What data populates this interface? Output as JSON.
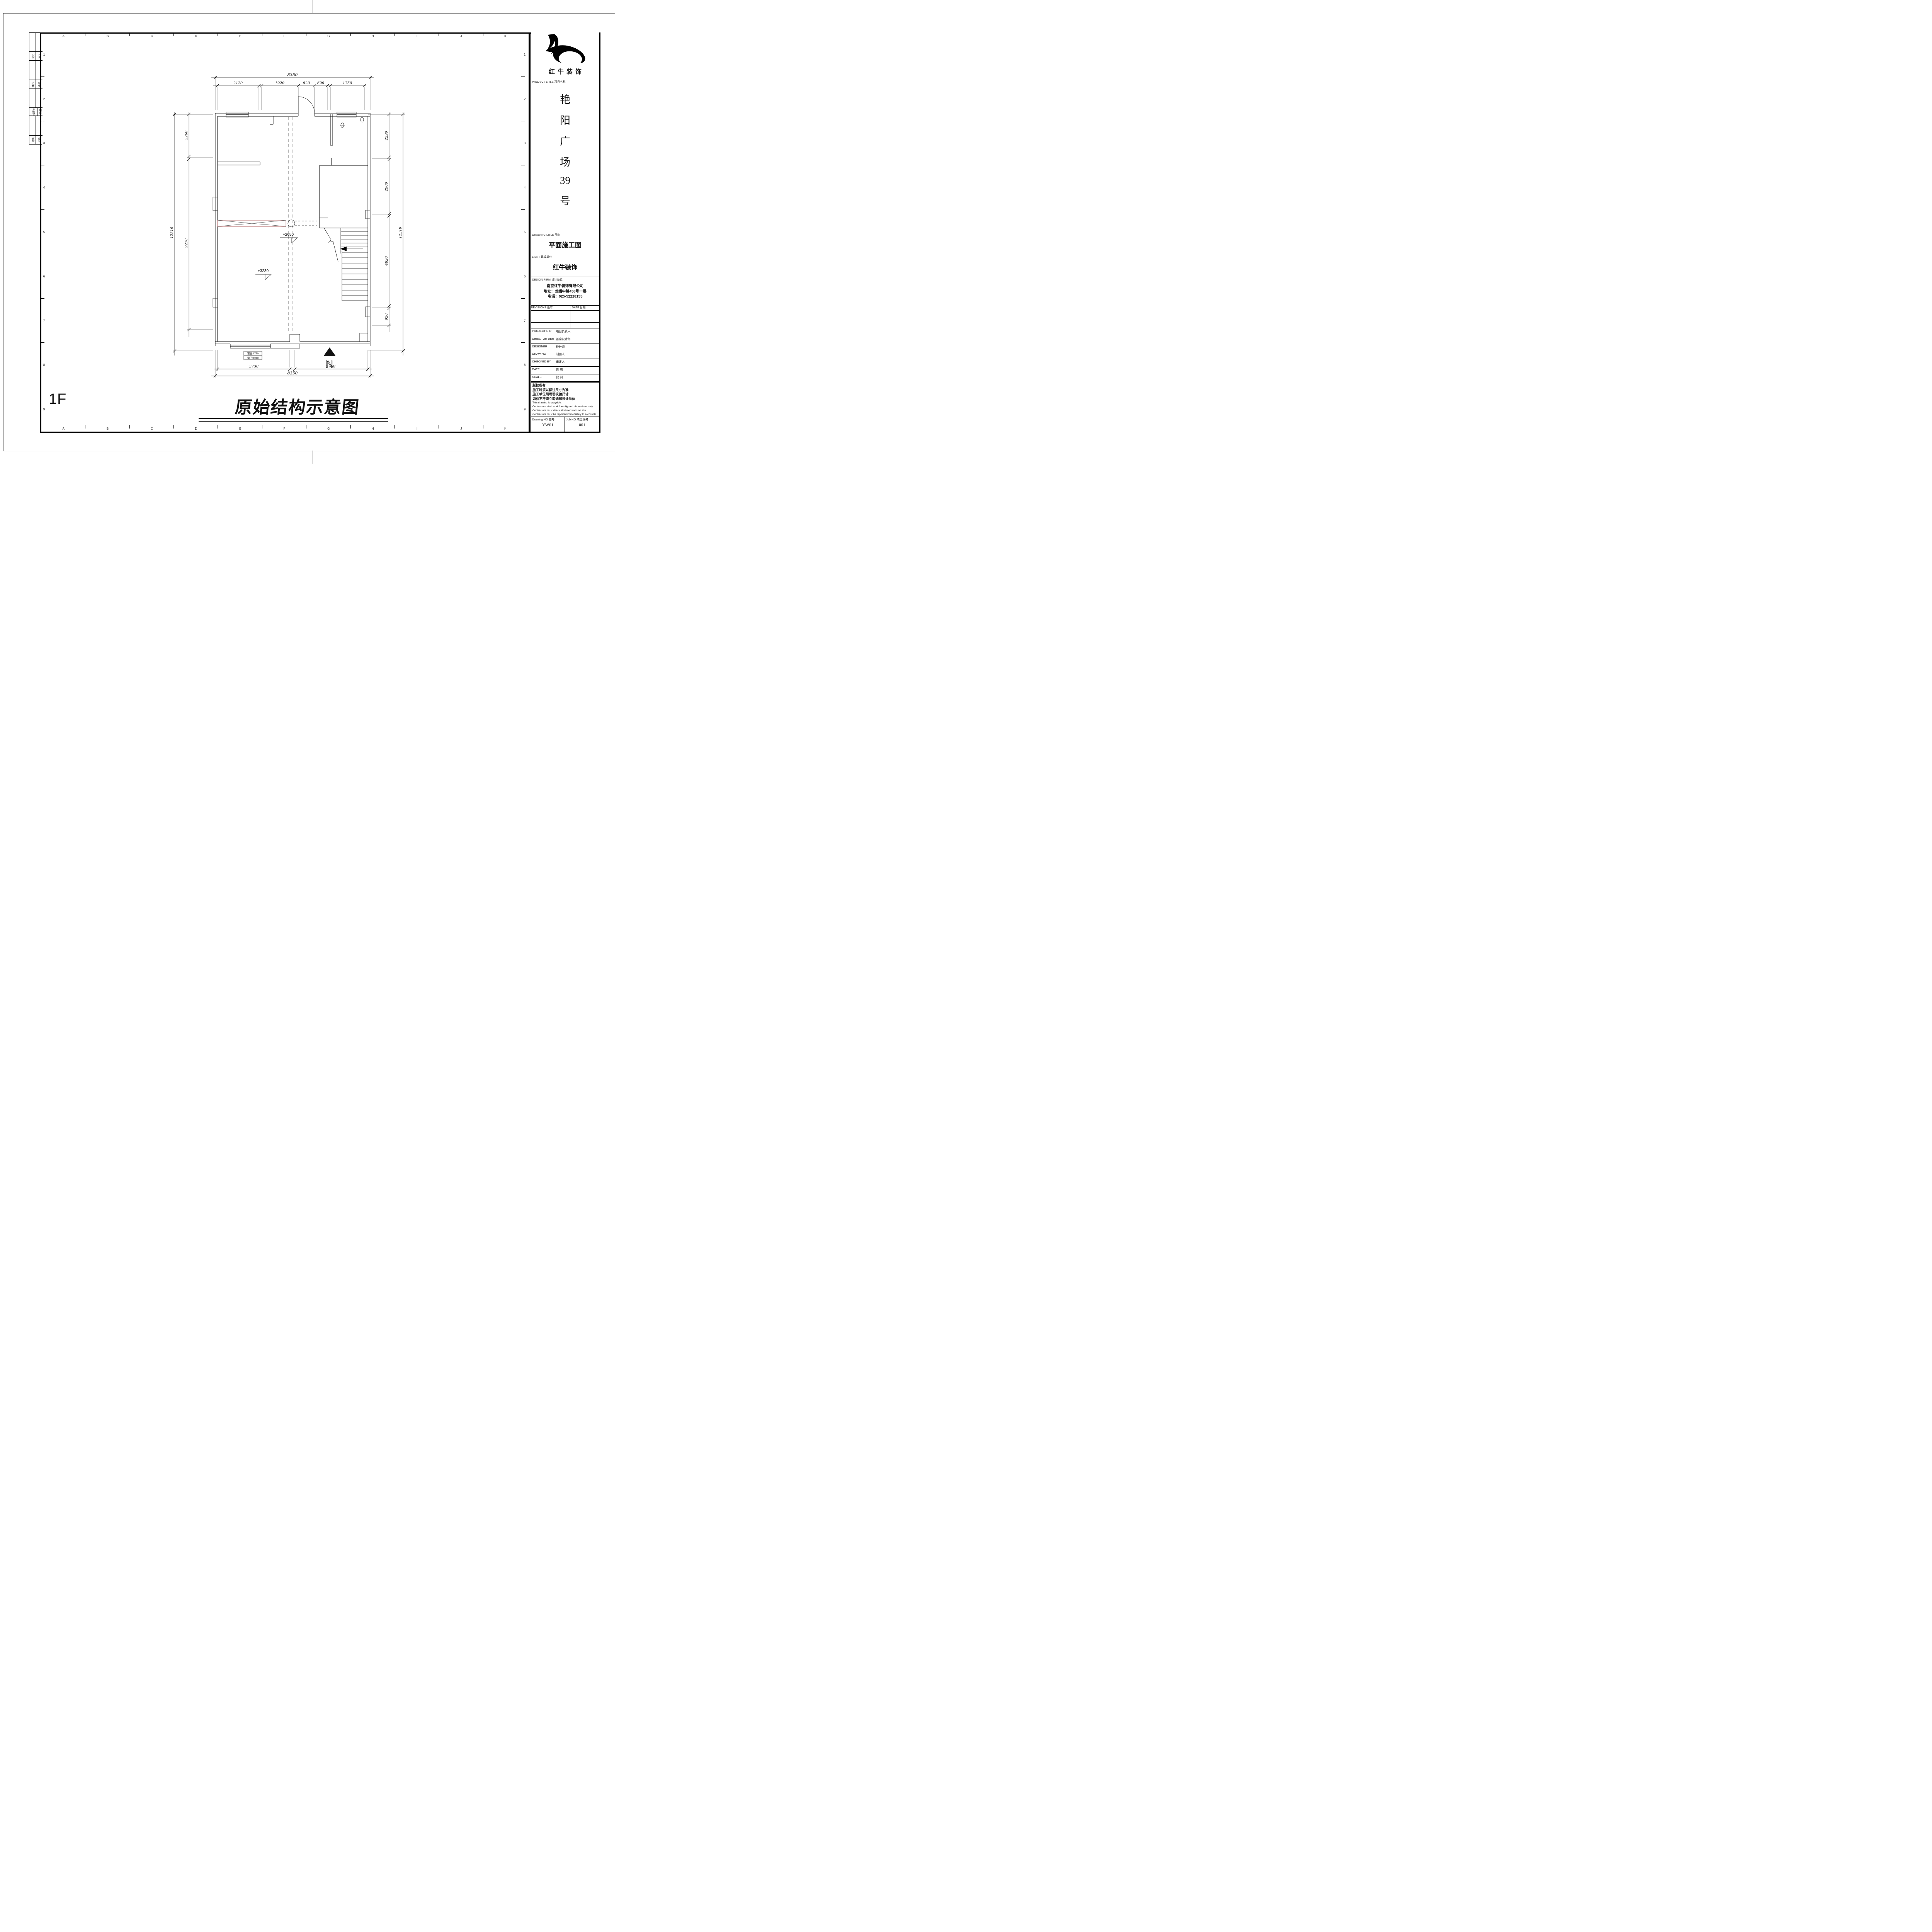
{
  "sheet": {
    "floor_label": "1F",
    "main_title": "原始结构示意图",
    "grid_cols": [
      "A",
      "B",
      "C",
      "D",
      "E",
      "F",
      "G",
      "H",
      "I",
      "J",
      "K"
    ],
    "grid_rows": [
      "1",
      "2",
      "3",
      "4",
      "5",
      "6",
      "7",
      "8",
      "9"
    ]
  },
  "signoff_rows": [
    {
      "a": "",
      "b": ""
    },
    {
      "a": "动力",
      "b": "校工"
    },
    {
      "a": "",
      "b": ""
    },
    {
      "a": "电气",
      "b": "电讯"
    },
    {
      "a": "",
      "b": ""
    },
    {
      "a": "给排水",
      "b": "暖通"
    },
    {
      "a": "",
      "b": ""
    },
    {
      "a": "建筑",
      "b": "结构"
    }
  ],
  "titleblock": {
    "logo_text": "红牛装饰",
    "project_label": "PROJECT LITLE  项目名称",
    "project_name_chars": [
      "艳",
      "阳",
      "广",
      "场",
      "39",
      "号"
    ],
    "drawing_label": "DRAWING LITLE  图名",
    "drawing_title": "平面施工图",
    "client_label": "LIENT  建设单位",
    "client_name": "红牛装饰",
    "firm_label": "DESIGN FIRM  设计单位",
    "firm_lines": [
      "南京红牛装饰有限公司",
      "地址：龙蟠中路458号一层",
      "电话：025-52228155"
    ],
    "revisions_label": "REVISIONS  版本",
    "date_label": "DATE  日期",
    "rows": [
      {
        "en": "PROJECT DIR",
        "zh": "项目负责人"
      },
      {
        "en": "DIRECTOR DER",
        "zh": "首席设计师"
      },
      {
        "en": "DESIGNER",
        "zh": "设计师"
      },
      {
        "en": "DRAWING",
        "zh": "制图人"
      },
      {
        "en": "CHECKED BY",
        "zh": "审定人"
      },
      {
        "en": "DATE",
        "zh": "日  期"
      },
      {
        "en": "SCALE",
        "zh": "比  例"
      }
    ],
    "copyright_zh": [
      "版权所有",
      "施工时须以标注尺寸为准",
      "施工单位须现场校验尺寸",
      "如有不符须立即通知设计单位"
    ],
    "copyright_en": [
      "This drawing is copyright",
      "Contractors shall work form figured dimensions only",
      "Contractors must check all dimensions on site",
      "Contractors must be reported immediately to architects"
    ],
    "drawing_no_label": "Drawing NO  图号",
    "drawing_no_value": "YW01",
    "job_no_label": "Job NO  项目编号",
    "job_no_value": "001"
  },
  "plan": {
    "dims": {
      "top_overall": "8350",
      "top_segments": [
        "2120",
        "1920",
        "820",
        "690",
        "1750"
      ],
      "bottom_segments": [
        "3730",
        "3760"
      ],
      "bottom_overall": "8350",
      "left_outer": "12310",
      "left_segments": [
        "2260",
        "9270"
      ],
      "right_segments": [
        "2290",
        "2900",
        "4820",
        "920"
      ],
      "right_outer": "12310"
    },
    "levels": [
      "+2650",
      "+3230"
    ],
    "window_note_line1": "窗高:1760",
    "window_note_line2": "窗下:1010",
    "north_label": "N"
  }
}
